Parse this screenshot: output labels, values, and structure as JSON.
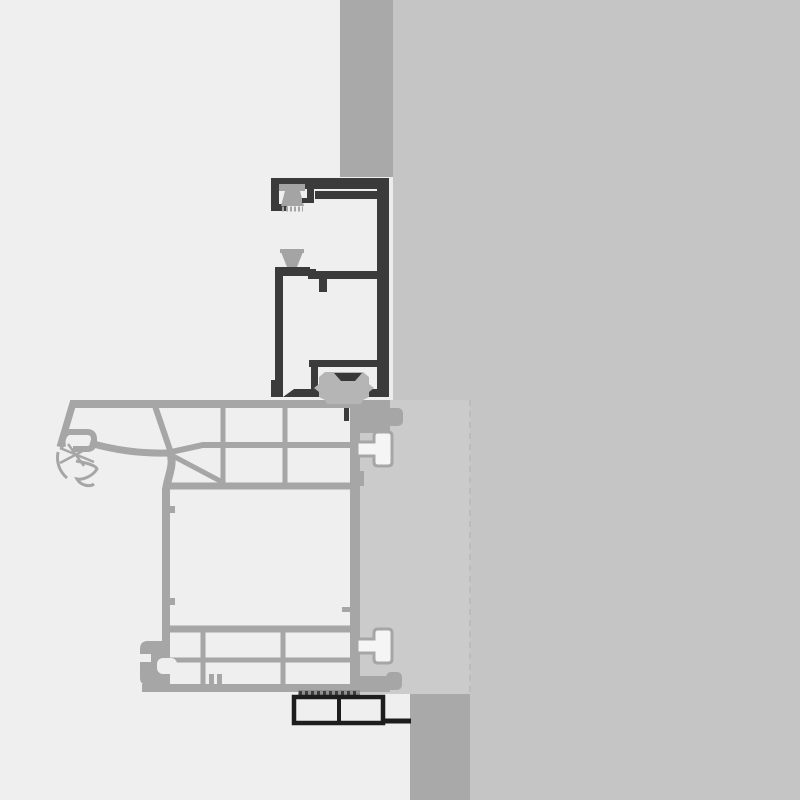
{
  "drawing": {
    "type": "technical-cross-section",
    "subject": "window frame installation detail, vertical section at wall jamb",
    "text_labels": []
  },
  "colors": {
    "bg_left": "#efefef",
    "bg_right": "#c5c5c5",
    "wall": "#a9a9a9",
    "panel": "#cbcbcb",
    "panel_edge": "#bcbcbc",
    "profile": "#a6a6a6",
    "t_fill": "#f5f5f5",
    "dark": "#3b3b3b",
    "darker": "#1d1d1d",
    "gasket": "#a4a4a4",
    "clip": "#b5b5b5",
    "clip_cap": "#383838",
    "hatch_base": "#8f8f8f",
    "hatch_dash": "#3d3d3d",
    "light_gap": "#ededed",
    "cell_fill": "#efefef"
  },
  "parts": {
    "exterior_background": "exterior side (light)",
    "interior_background": "interior / masonry side (gray)",
    "wall_above": "wall strip above frame",
    "wall_below": "wall strip below sill",
    "mounting_panel": "mounting / insulation panel",
    "frame_head_profile": "dark head frame profile with glazing gaskets",
    "sill_profile": "gray multi-chamber sill profile",
    "anchor_tabs": "white T-anchor connectors",
    "roller_clip": "roller / fitting clip",
    "base_plate": "dark base plate with seal strip"
  }
}
